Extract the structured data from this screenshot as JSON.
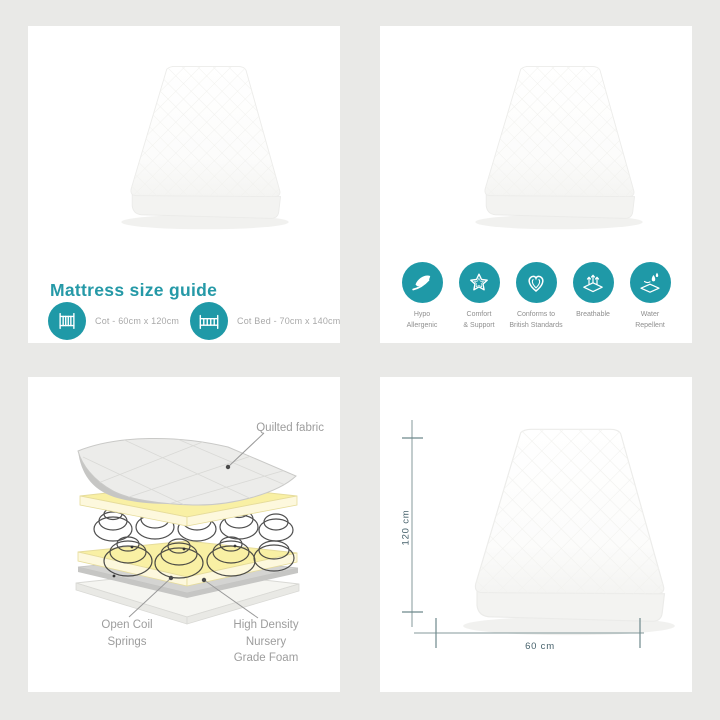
{
  "colors": {
    "accent_teal": "#1f99a7",
    "background": "#e9e9e7"
  },
  "size_guide": {
    "title": "Mattress size guide",
    "items": [
      {
        "icon": "cot-icon",
        "label": "Cot - 60cm x 120cm"
      },
      {
        "icon": "cot-bed-icon",
        "label": "Cot Bed - 70cm x 140cm"
      }
    ]
  },
  "features": {
    "items": [
      {
        "icon": "feather-icon",
        "label": "Hypo\nAllergenic"
      },
      {
        "icon": "star-icon",
        "label": "Comfort\n& Support"
      },
      {
        "icon": "heart-icon",
        "label": "Conforms to\nBritish Standards"
      },
      {
        "icon": "breathable-icon",
        "label": "Breathable"
      },
      {
        "icon": "water-drops-icon",
        "label": "Water\nRepellent"
      }
    ]
  },
  "construction": {
    "quilted_fabric_label": "Quilted fabric",
    "springs_label": "Open Coil\nSprings",
    "foam_label": "High Density\nNursery\nGrade Foam"
  },
  "dimensions": {
    "height_label": "120 cm",
    "width_label": "60 cm"
  }
}
